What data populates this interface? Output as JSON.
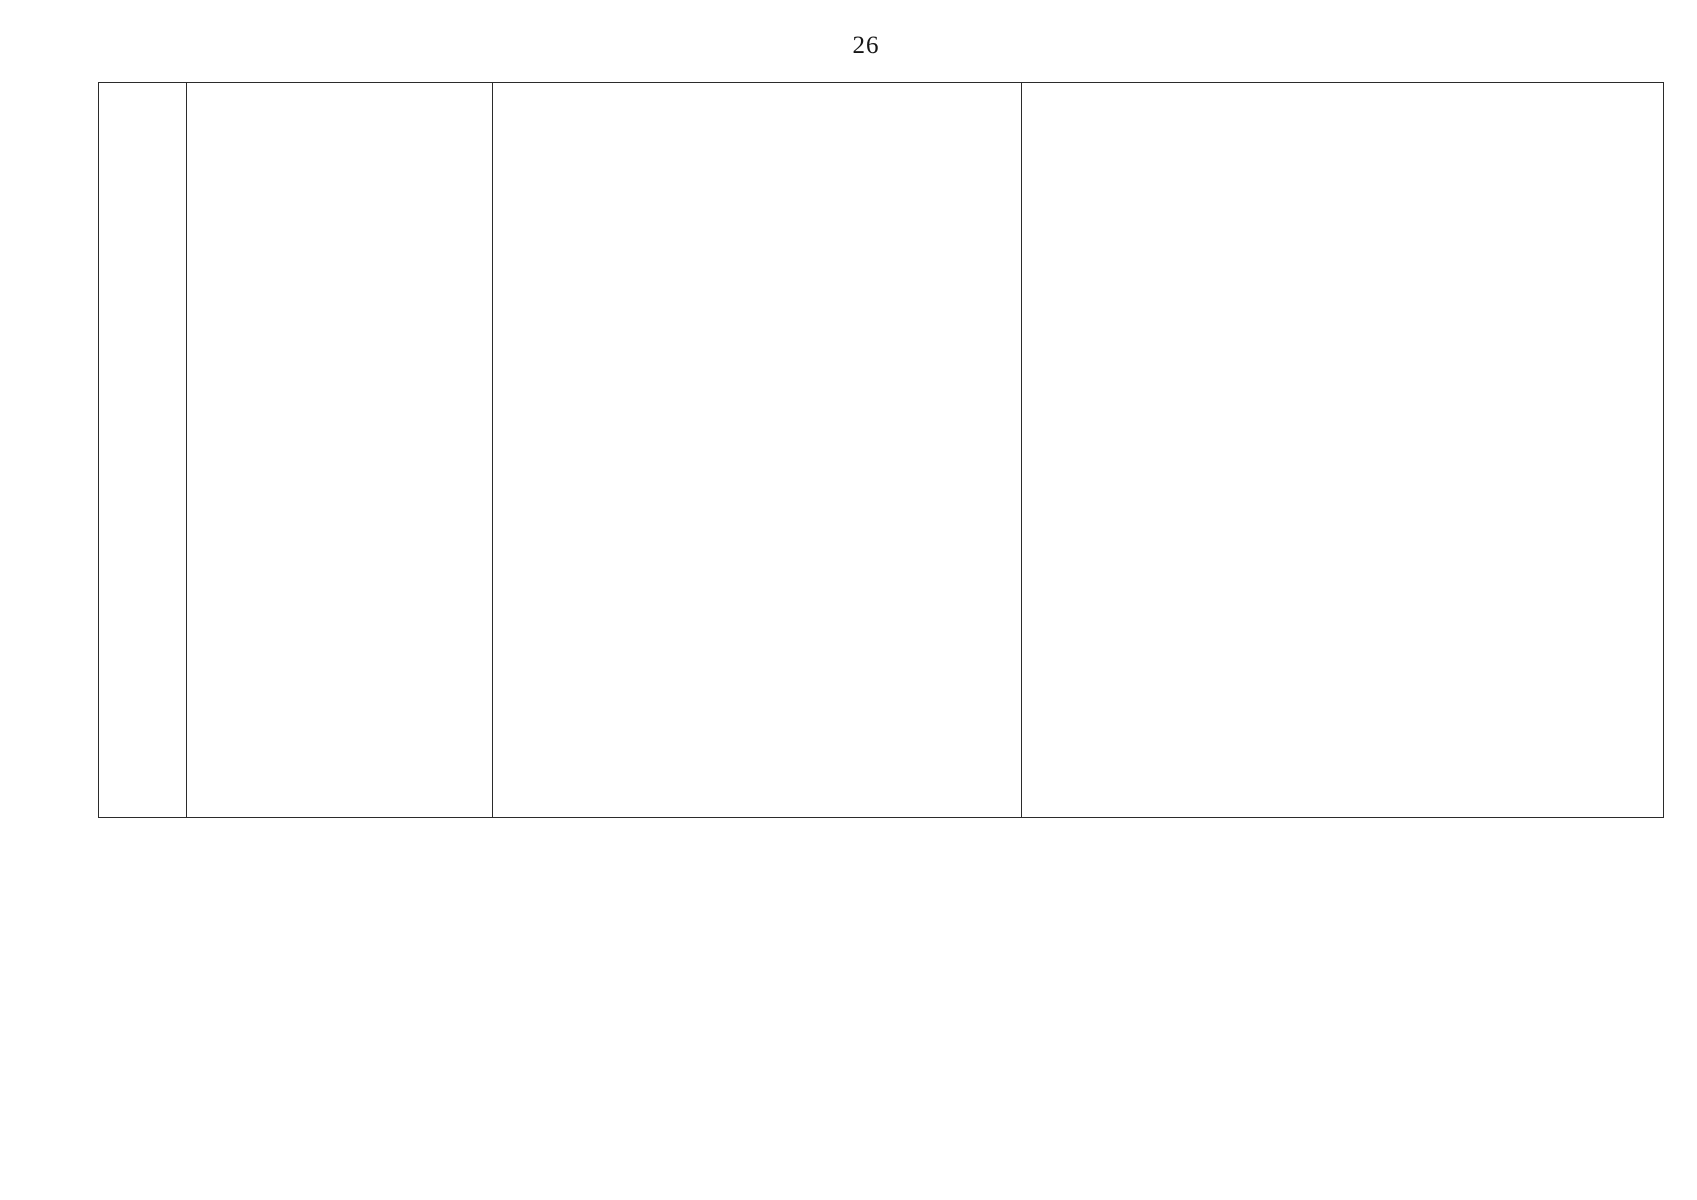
{
  "page": {
    "number": "26",
    "paper_color": "#ffffff",
    "ink_color": "#2b2b2b"
  },
  "document_table": {
    "row_count_visible": 1,
    "columns": [
      {
        "id": "col-1",
        "content": ""
      },
      {
        "id": "col-2",
        "content": ""
      },
      {
        "id": "col-3",
        "content": ""
      },
      {
        "id": "col-4",
        "content": "photographs"
      }
    ]
  },
  "photos": {
    "photo_1": {
      "description": "Black-and-white halftone photograph: dilapidated brick outbuilding with crumbling corner brickwork and a dark open interior, sloping corrugated roof at left, multi-storey apartment buildings and a large dark tree behind, car at right edge"
    },
    "photo_2": {
      "description": "Black-and-white halftone photograph: interior of a wooden plank shed with tools leaning against the walls - ladder, long sticks, shovel, sledgehammer - and a light stump with an object on it in the centre"
    }
  }
}
